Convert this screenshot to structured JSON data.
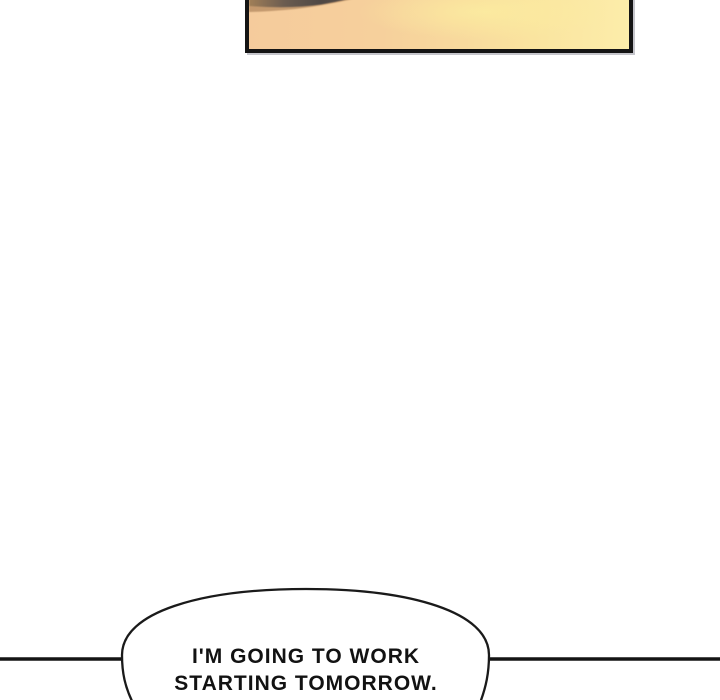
{
  "page": {
    "background": "#ffffff",
    "kind": "webtoon comic page segment"
  },
  "panel": {
    "description": "cropped sunset-gradient comic panel with dark hair shape at top",
    "border_color": "#141414",
    "gradient_left": "#f5cb9c",
    "gradient_mid": "#f8d99d",
    "gradient_right": "#fcedaa",
    "shape_dark": "#554c47",
    "shape_tan": "#bb9166"
  },
  "divider": {
    "color": "#141414"
  },
  "speech_bubble": {
    "line1": "I'M GOING TO WORK",
    "line2": "STARTING TOMORROW.",
    "fill": "#ffffff",
    "stroke": "#1a1a1a",
    "text_color": "#121212"
  }
}
